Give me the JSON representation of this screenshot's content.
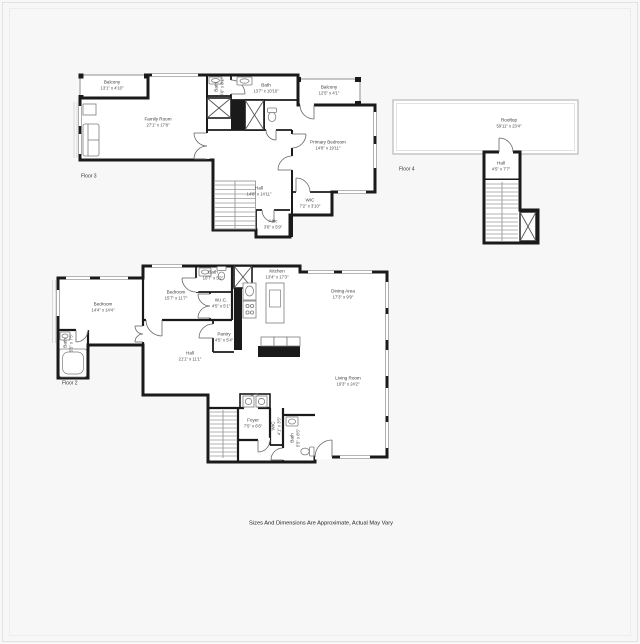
{
  "disclaimer": "Sizes And Dimensions Are Approximate, Actual May Vary",
  "colors": {
    "wall": "#1a1a1a",
    "background": "#f7f7f7",
    "thin_wall": "#b8b8b8"
  },
  "floor3": {
    "floor_label": "Floor 3",
    "rooms": {
      "balcony_left": {
        "name": "Balcony",
        "dims": "13'1\" x 4'10\""
      },
      "family_room": {
        "name": "Family Room",
        "dims": "27'1\" x 17'8\""
      },
      "bath_small": {
        "name": "Bath",
        "dims": "4'9\" x 8'1\""
      },
      "bath": {
        "name": "Bath",
        "dims": "13'7\" x 10'10\""
      },
      "balcony_right": {
        "name": "Balcony",
        "dims": "12'5\" x 4'1\""
      },
      "primary_bedroom": {
        "name": "Primary Bedroom",
        "dims": "14'8\" x 19'11\""
      },
      "wic": {
        "name": "WIC",
        "dims": "7'2\" x 3'10\""
      },
      "hall": {
        "name": "Hall",
        "dims": "14'8\" x 14'11\""
      },
      "attic": {
        "name": "Attic",
        "dims": "3'8\" x 5'9\""
      }
    }
  },
  "floor4": {
    "floor_label": "Floor 4",
    "rooms": {
      "rooftop": {
        "name": "Rooftop",
        "dims": "59'11\" x 23'4\""
      },
      "hall": {
        "name": "Hall",
        "dims": "4'5\" x 7'7\""
      }
    }
  },
  "floor2": {
    "floor_label": "Floor 2",
    "rooms": {
      "bedroom_left": {
        "name": "Bedroom",
        "dims": "14'4\" x 14'4\""
      },
      "bath_left": {
        "name": "Bath",
        "dims": "5'5\" x 7'5\""
      },
      "bedroom_mid": {
        "name": "Bedroom",
        "dims": "15'7\" x 11'7\""
      },
      "bath_top": {
        "name": "Bath",
        "dims": "10'7\" x 5'2\""
      },
      "wic_top": {
        "name": "W.I.C.",
        "dims": "4'5\" x 5'1\""
      },
      "pantry": {
        "name": "Pantry",
        "dims": "4'5\" x 5'4\""
      },
      "kitchen": {
        "name": "Kitchen",
        "dims": "13'4\" x 17'3\""
      },
      "dining_area": {
        "name": "Dining Area",
        "dims": "17'3\" x 9'9\""
      },
      "living_room": {
        "name": "Living Room",
        "dims": "19'3\" x 24'2\""
      },
      "hall": {
        "name": "Hall",
        "dims": "21'1\" x 11'1\""
      },
      "foyer": {
        "name": "Foyer",
        "dims": "7'5\" x 6'6\""
      },
      "wic_small": {
        "name": "WIC",
        "dims": "4'1\" x 3'5\""
      },
      "bath_bottom": {
        "name": "Bath",
        "dims": "5'5\" x 8'5\""
      }
    }
  }
}
